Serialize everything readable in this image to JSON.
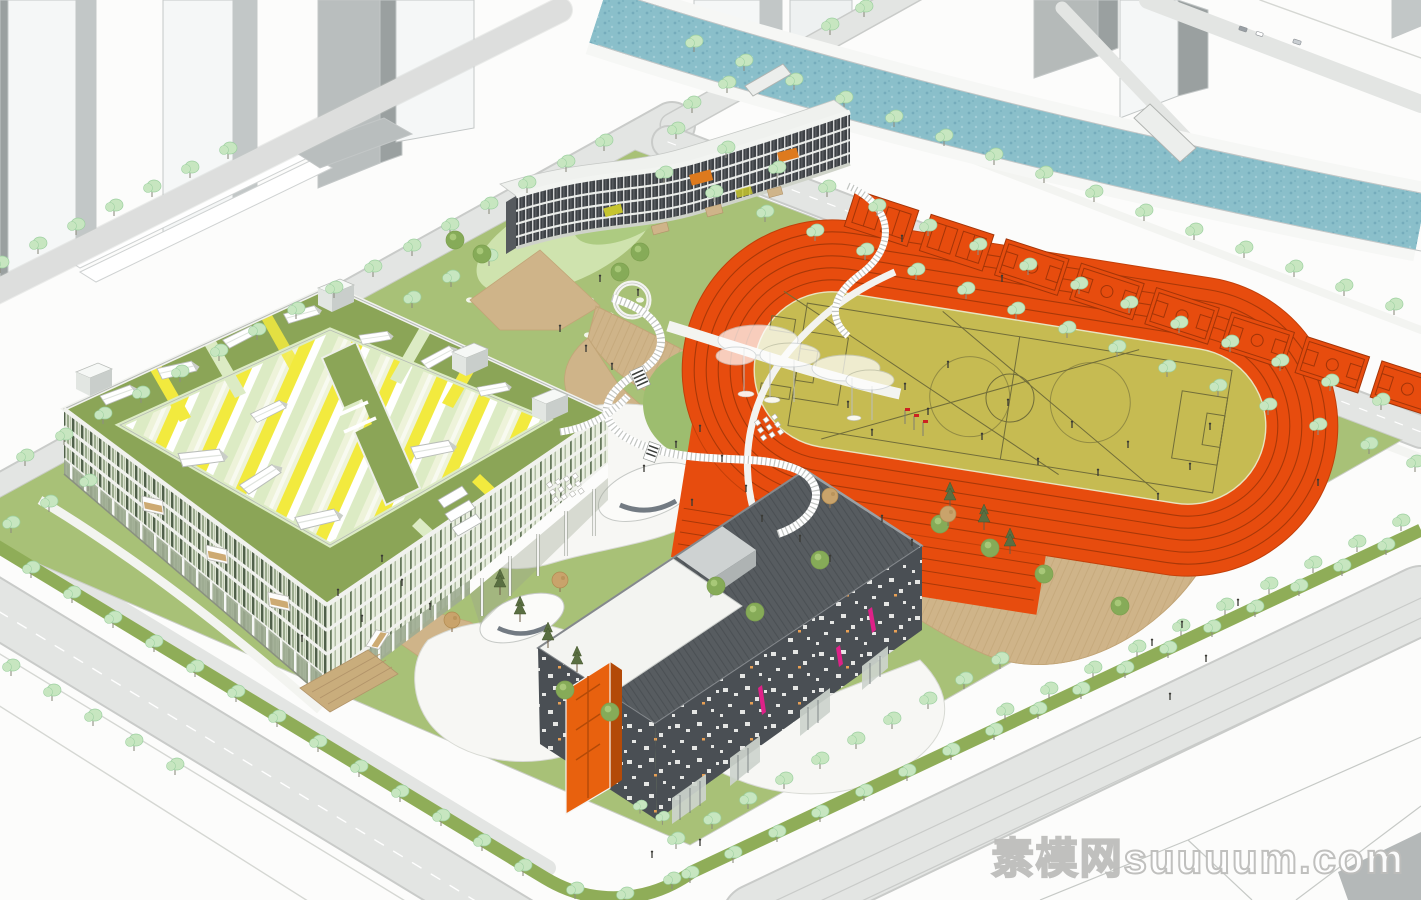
{
  "watermark": {
    "text": "素模网suuuum.com"
  },
  "scene": {
    "type": "aerial axonometric architectural rendering",
    "site": "school campus with sports field",
    "elements": [
      "teaching-complex",
      "dormitory-slab",
      "gymnasium",
      "running-track",
      "football-infield",
      "basketball-courts",
      "river",
      "street-trees",
      "central-plaza",
      "cloud-canopies",
      "elevated-walkways",
      "context-towers",
      "roads"
    ]
  },
  "colors": {
    "bg": "#fcfcfb",
    "white": "#ffffff",
    "road": "#e3e5e3",
    "road_edge": "#c2c4c2",
    "upper_road": "#e8e9e8",
    "site_green": "#a8c177",
    "lawn_deep": "#8fb35f",
    "lawn_pale": "#cfe3ae",
    "median_green": "#8fad58",
    "tree_light": "#c7e6c0",
    "tree_edge": "#9cd0a0",
    "tree_trunk": "#8e8e80",
    "tree_dark": "#86ab58",
    "pine": "#5a6f42",
    "autumn": "#c9a36b",
    "water": "#8abfca",
    "water_dot": "#649db0",
    "track_orange": "#e74c0e",
    "track_line": "#a93808",
    "field_olive": "#c6bb52",
    "field_line": "#716d39",
    "court_line": "#a33508",
    "roof_green": "#8ba557",
    "stripe_yellow": "#f2ea3e",
    "stripe_pale": "#dcebc4",
    "stripe_cream": "#eef3da",
    "facade_base": "#dde4d2",
    "facade_dark": "#50604a",
    "facade_mid": "#8a9b7c",
    "floor_white": "#f1f2ee",
    "glass_dark": "#9fac92",
    "dorm_dark": "#3e4246",
    "dorm_roof": "#eff1ee",
    "dorm_orange": "#de7a1e",
    "dorm_yellow": "#c6c42f",
    "gym_dark": "#4a4f54",
    "gym_roof": "#575c60",
    "gym_white": "#f3f4f1",
    "gym_orange": "#e8610e",
    "gym_orange_dark": "#b34a08",
    "magenta": "#df2188",
    "deck_tan": "#cfb489",
    "deck_line": "#bfa173",
    "steps_tan": "#c9ad7c",
    "plaza_white": "#f7f7f4",
    "rail_gray": "#8f9590",
    "context_front": "#f5f7f7",
    "context_side": "#c2c7c7",
    "context_dark": "#9aa0a0",
    "context_gray": "#b9bebe",
    "people": "#3a3a35",
    "red_flag": "#cc2222",
    "wm_stroke": "#bdbdbb"
  }
}
